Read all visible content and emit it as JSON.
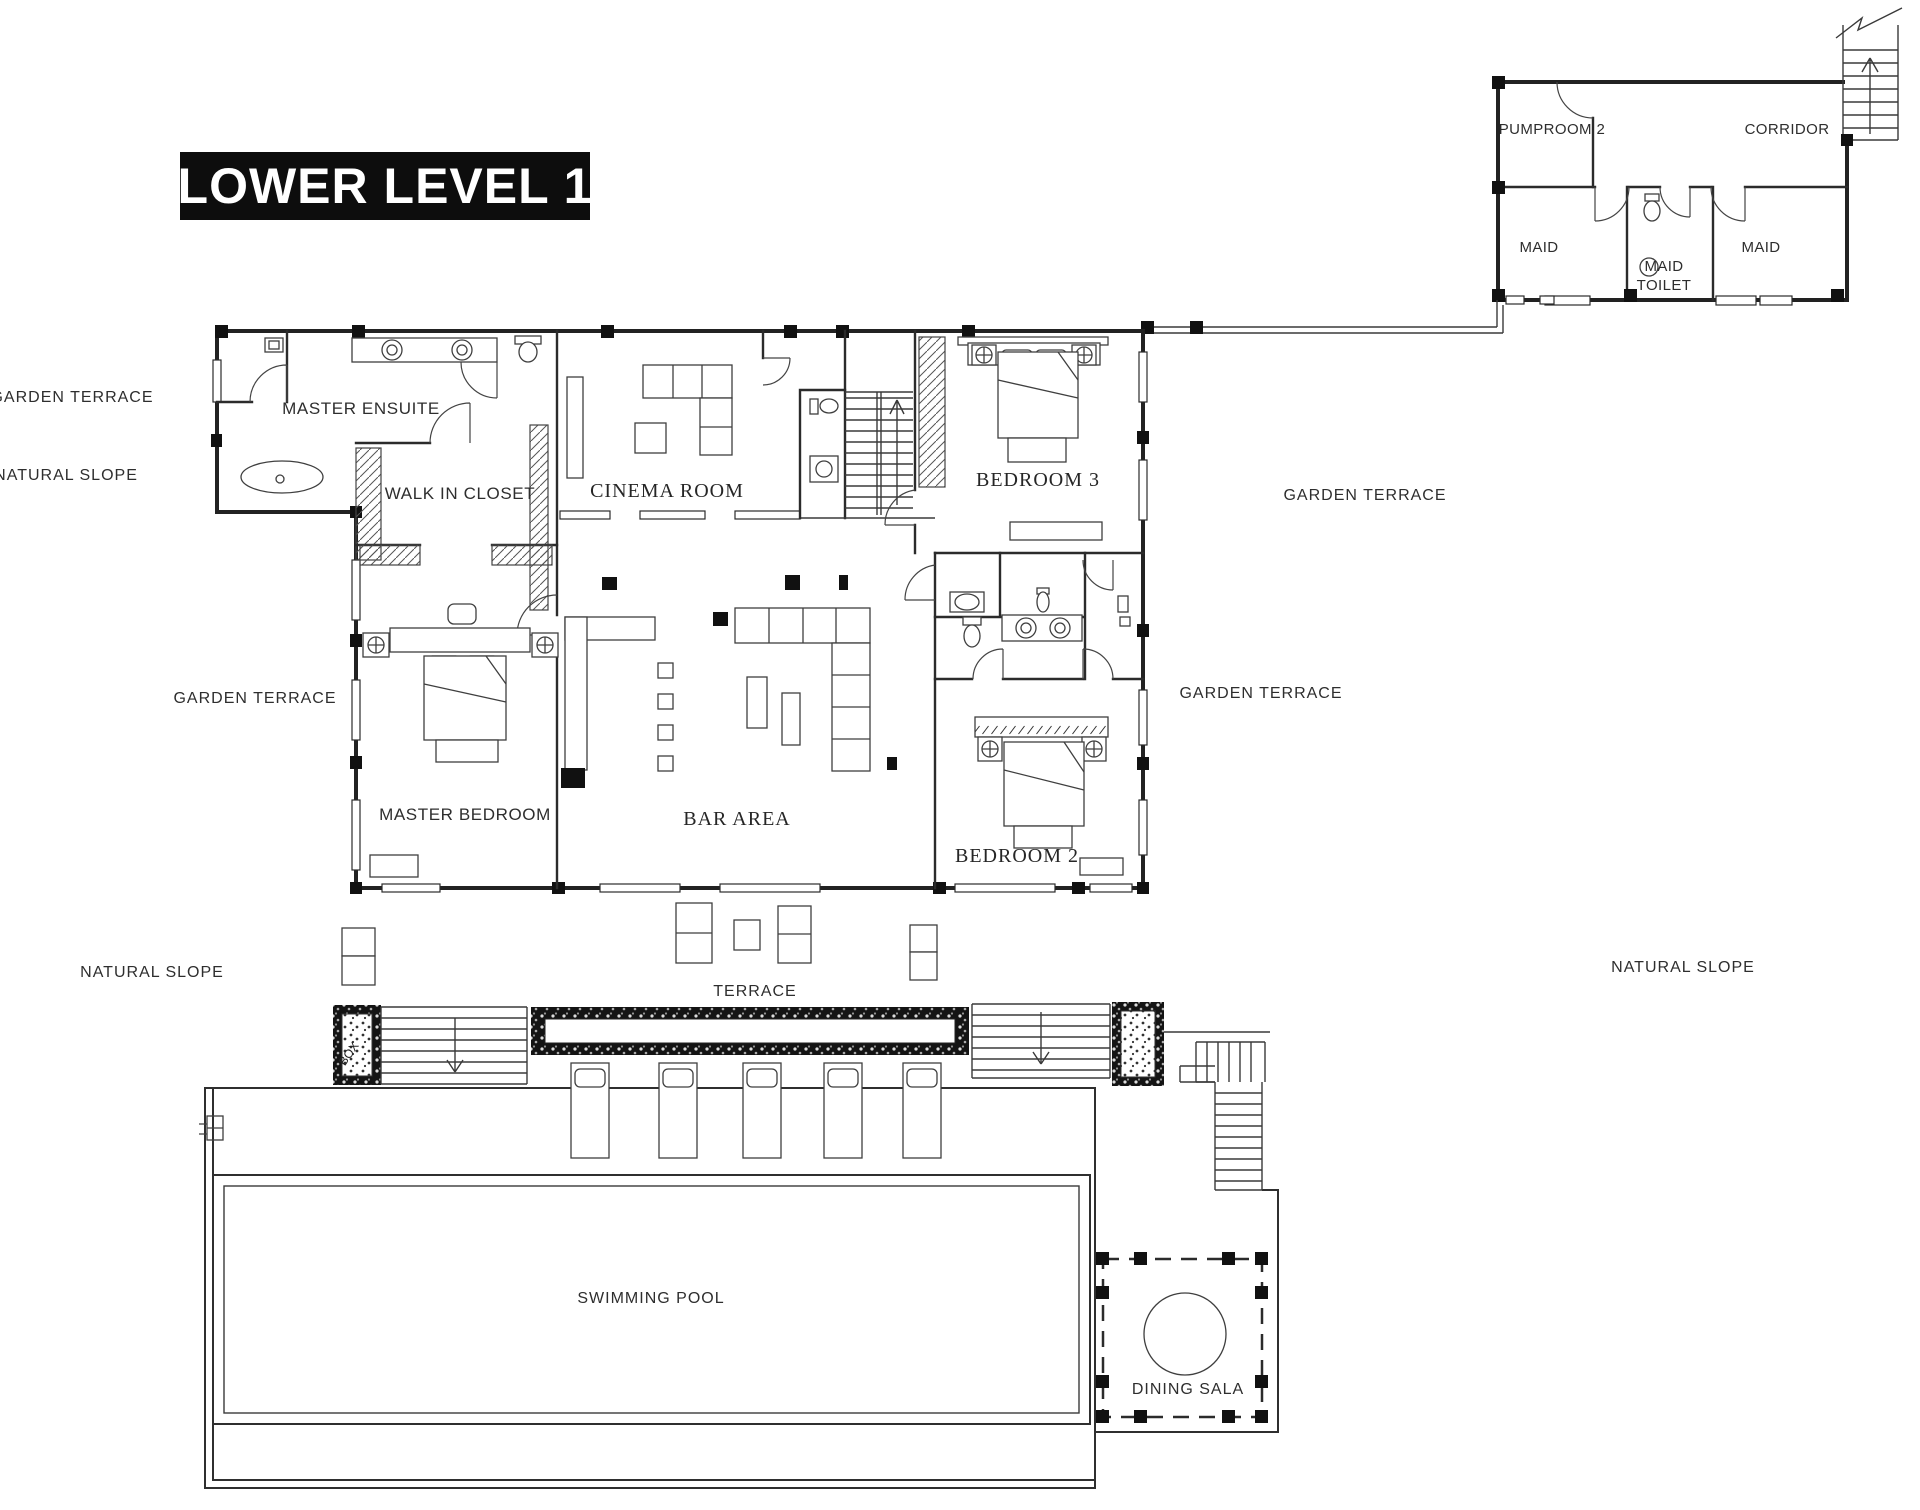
{
  "title": "LOWER LEVEL 1",
  "colors": {
    "line": "#2b2b2b",
    "wall": "#222222",
    "title_bg": "#0d0d0d",
    "title_fg": "#ffffff",
    "paper": "#ffffff"
  },
  "rooms": {
    "master_ensuite": "MASTER ENSUITE",
    "walk_in_closet": "WALK IN CLOSET",
    "cinema_room": "CINEMA ROOM",
    "bedroom_3": "BEDROOM 3",
    "master_bedroom": "MASTER BEDROOM",
    "bar_area": "BAR AREA",
    "bedroom_2": "BEDROOM 2",
    "terrace": "TERRACE",
    "swimming_pool": "SWIMMING POOL",
    "dining_sala": "DINING SALA",
    "pumproom_2": "PUMPROOM 2",
    "corridor": "CORRIDOR",
    "maid_left": "MAID",
    "maid_toilet_line1": "MAID",
    "maid_toilet_line2": "TOILET",
    "maid_right": "MAID",
    "planter_box": "BOX"
  },
  "site_labels": {
    "garden_terrace_top_left": "GARDEN TERRACE",
    "natural_slope_top_left": "NATURAL SLOPE",
    "garden_terrace_mid_left": "GARDEN TERRACE",
    "garden_terrace_top_right": "GARDEN TERRACE",
    "garden_terrace_mid_right": "GARDEN TERRACE",
    "natural_slope_bottom_left": "NATURAL SLOPE",
    "natural_slope_bottom_right": "NATURAL SLOPE"
  }
}
